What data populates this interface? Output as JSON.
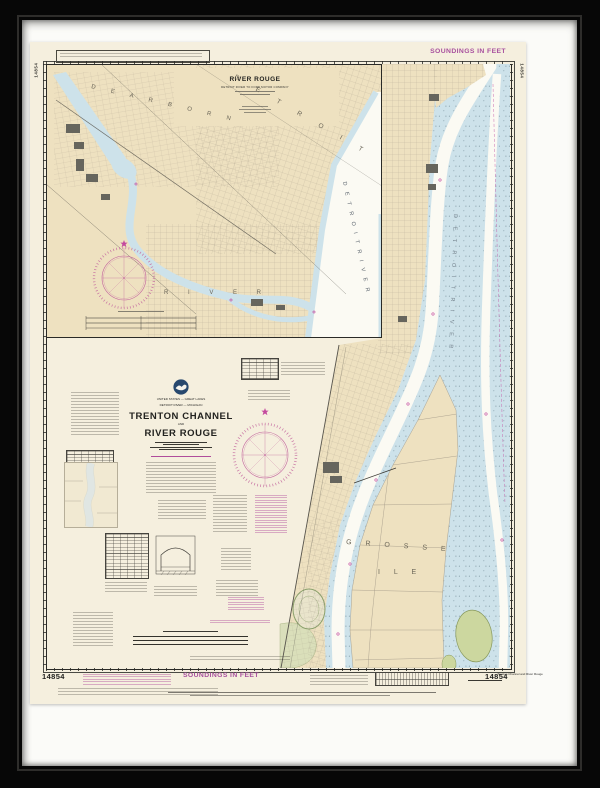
{
  "artwork": {
    "kind": "framed NOAA nautical chart print",
    "chart_number": "14854",
    "colors": {
      "frame": "#070707",
      "mat": "#fbfbf8",
      "paper": "#f5efde",
      "land_tan": "#eee1c0",
      "water_blue": "#cde2ea",
      "channel_white": "#fbfaf3",
      "island_green": "#ccd79f",
      "marsh_green": "#d9dfba",
      "magenta": "#a8509e",
      "compass_magenta": "#c4699f",
      "building_gray": "#66655d",
      "ink": "#2b2b28"
    }
  },
  "header": {
    "soundings_top": "SOUNDINGS IN FEET",
    "side_number_left": "14854",
    "side_number_right": "14854"
  },
  "inset": {
    "title": "RIVER ROUGE",
    "subtitle": "DETROIT RIVER TO FORD MOTOR COMPANY"
  },
  "title_block": {
    "country_line": "UNITED STATES — GREAT LAKES",
    "region_line": "DETROIT RIVER — MICHIGAN",
    "title_line1": "TRENTON CHANNEL",
    "title_conjunction": "AND",
    "title_line2": "RIVER ROUGE"
  },
  "map_labels": {
    "dearborn": "D E A R B O R N",
    "detroit": "D E T R O I T",
    "river": "R I V E R",
    "detroit_river": "D E T R O I T   R I V E R",
    "grosse": "G R O S S E",
    "ile": "I L E"
  },
  "footer": {
    "number_left": "14854",
    "soundings_bottom": "SOUNDINGS IN FEET",
    "caption": "Trenton Channel and River Rouge",
    "number_right": "14854"
  }
}
